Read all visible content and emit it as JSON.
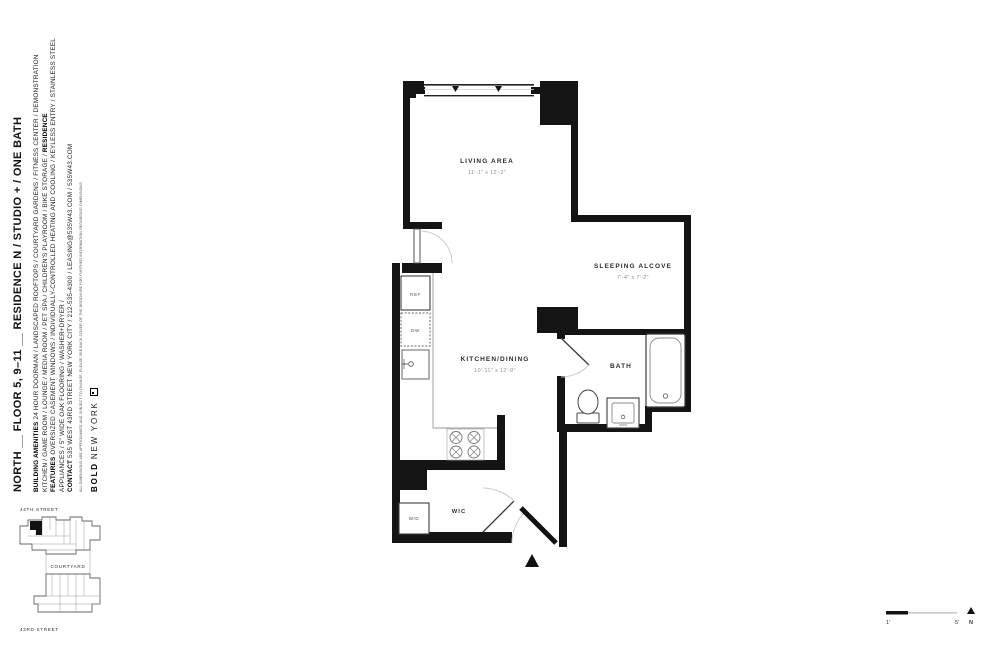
{
  "sidebar": {
    "title": "NORTH __ FLOOR 5, 9–11 __ RESIDENCE N / STUDIO + / ONE BATH",
    "amenities_label": "BUILDING AMENITIES",
    "amenities_text": "24 HOUR DOORMAN / LANDSCAPED ROOFTOPS / COURTYARD GARDENS / FITNESS CENTER / DEMONSTRATION KITCHEN / GAME ROOM / LOUNGE / MEDIA ROOM / PET SPA / CHILDREN'S PLAYROOM / BIKE STORAGE /",
    "features_label": "RESIDENCE FEATURES",
    "features_text": "OVERSIZED CASEMENT WINDOWS / INDIVIDUALLY-CONTROLLED HEATING AND COOLING / KEYLESS ENTRY / STAINLESS STEEL APPLIANCES / 5\" WIDE OAK FLOORING / WASHER+DRYER /",
    "contact_label": "CONTACT",
    "contact_text": "535 WEST 43RD STREET NEW YORK CITY / 212-535-4300 / LEASING@535W43.COM / 535W43.COM",
    "disclaimer": "ALL DIMENSIONS ARE APPROXIMATE AND SUBJECT TO CHANGE. PLEASE SEE BACK COVER OF THE BROCHURE FOR FURTHER INFORMATION REGARDING DIMENSIONS.",
    "logo_bold": "BOLD",
    "logo_newyork": "NEW YORK"
  },
  "plan": {
    "living": {
      "name": "LIVING AREA",
      "dims": "11'-1\" x 12'-2\""
    },
    "alcove": {
      "name": "SLEEPING ALCOVE",
      "dims": "7'-4\" x 7'-2\""
    },
    "kitchen": {
      "name": "KITCHEN/DINING",
      "dims": "10'-11\" x 12'-9\""
    },
    "bath": {
      "name": "BATH"
    },
    "wic": {
      "name": "WIC"
    },
    "ref_label": "REF",
    "dw_label": "DW",
    "wd_label": "W/D",
    "wall_color": "#141414"
  },
  "sitemap": {
    "street_top": "44TH STREET",
    "courtyard": "COURTYARD",
    "street_bottom": "43RD STREET"
  },
  "scalebar": {
    "start_label": "1'",
    "end_label": "5'",
    "north_label": "N"
  }
}
